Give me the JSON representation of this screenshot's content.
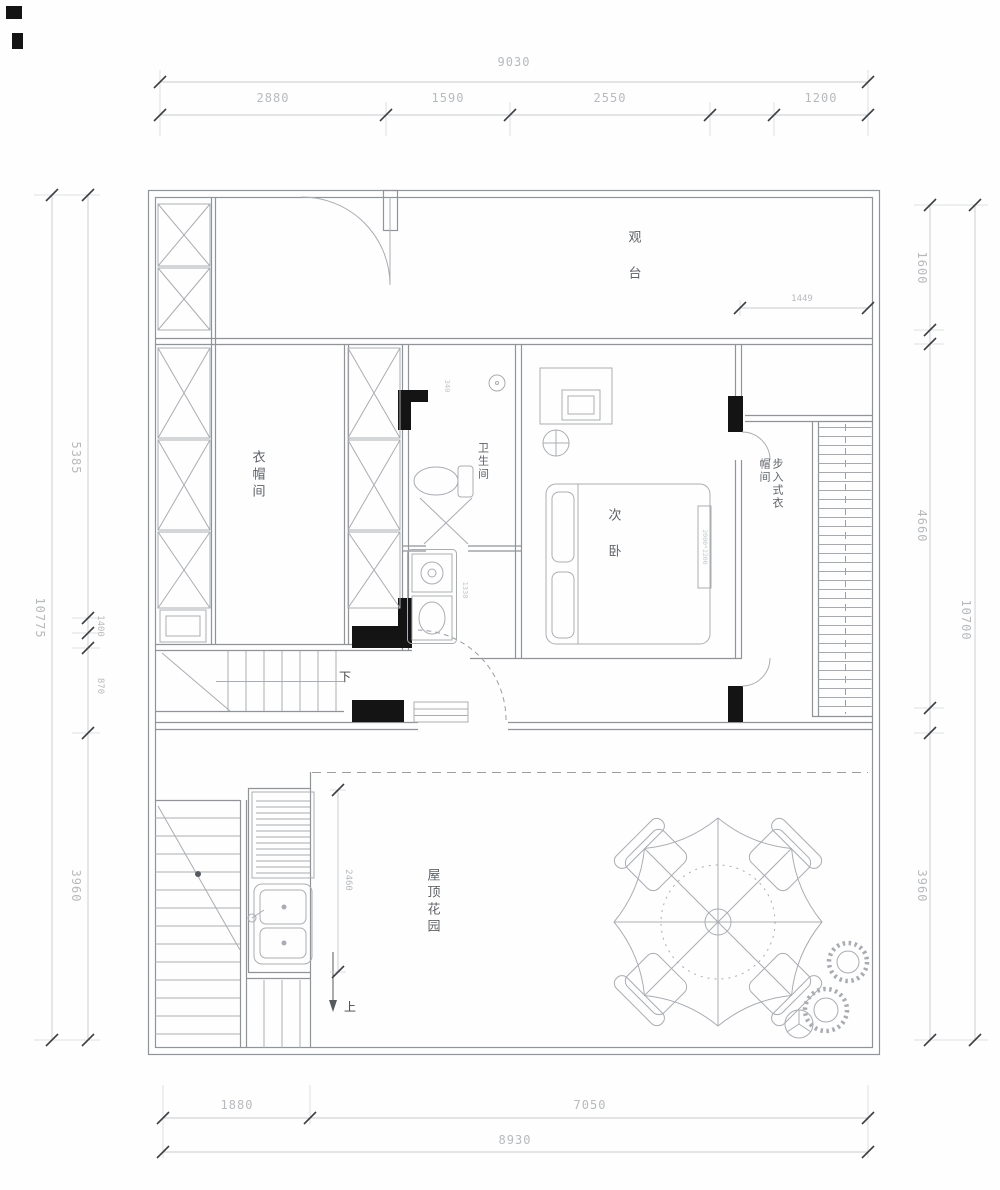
{
  "meta": {
    "type": "architectural-floor-plan",
    "floor": "roof-level"
  },
  "colors": {
    "wall_line": "#8f9499",
    "fixture_line": "#a9adb2",
    "dim_line": "#c6c9cc",
    "dim_text": "#b7babd",
    "room_text": "#5e6267",
    "wall_fill": "#141414"
  },
  "rooms": {
    "deck": "观 台",
    "cloak": "衣帽间",
    "bath": "卫生间",
    "bedroom": "次 卧",
    "walkin": "步入式衣\n帽间",
    "garden": "屋顶花园"
  },
  "stairs": {
    "down": "下",
    "up": "上"
  },
  "dims": {
    "top": {
      "overall": "9030",
      "s1": "2880",
      "s2": "1590",
      "s3": "2550",
      "s4": "1200"
    },
    "bottom": {
      "overall": "8930",
      "s1": "1880",
      "s2": "7050"
    },
    "left": {
      "overall": "10775",
      "s1": "5385",
      "s2": "1400",
      "s3": "870",
      "s4": "3960"
    },
    "right": {
      "overall": "10700",
      "s1": "1600",
      "s2": "4660",
      "s3": "3960"
    },
    "detail": {
      "deck": "1449",
      "kitchen": "2460",
      "bath": "340",
      "vanity": "1330",
      "bed": "2000*2200"
    }
  }
}
